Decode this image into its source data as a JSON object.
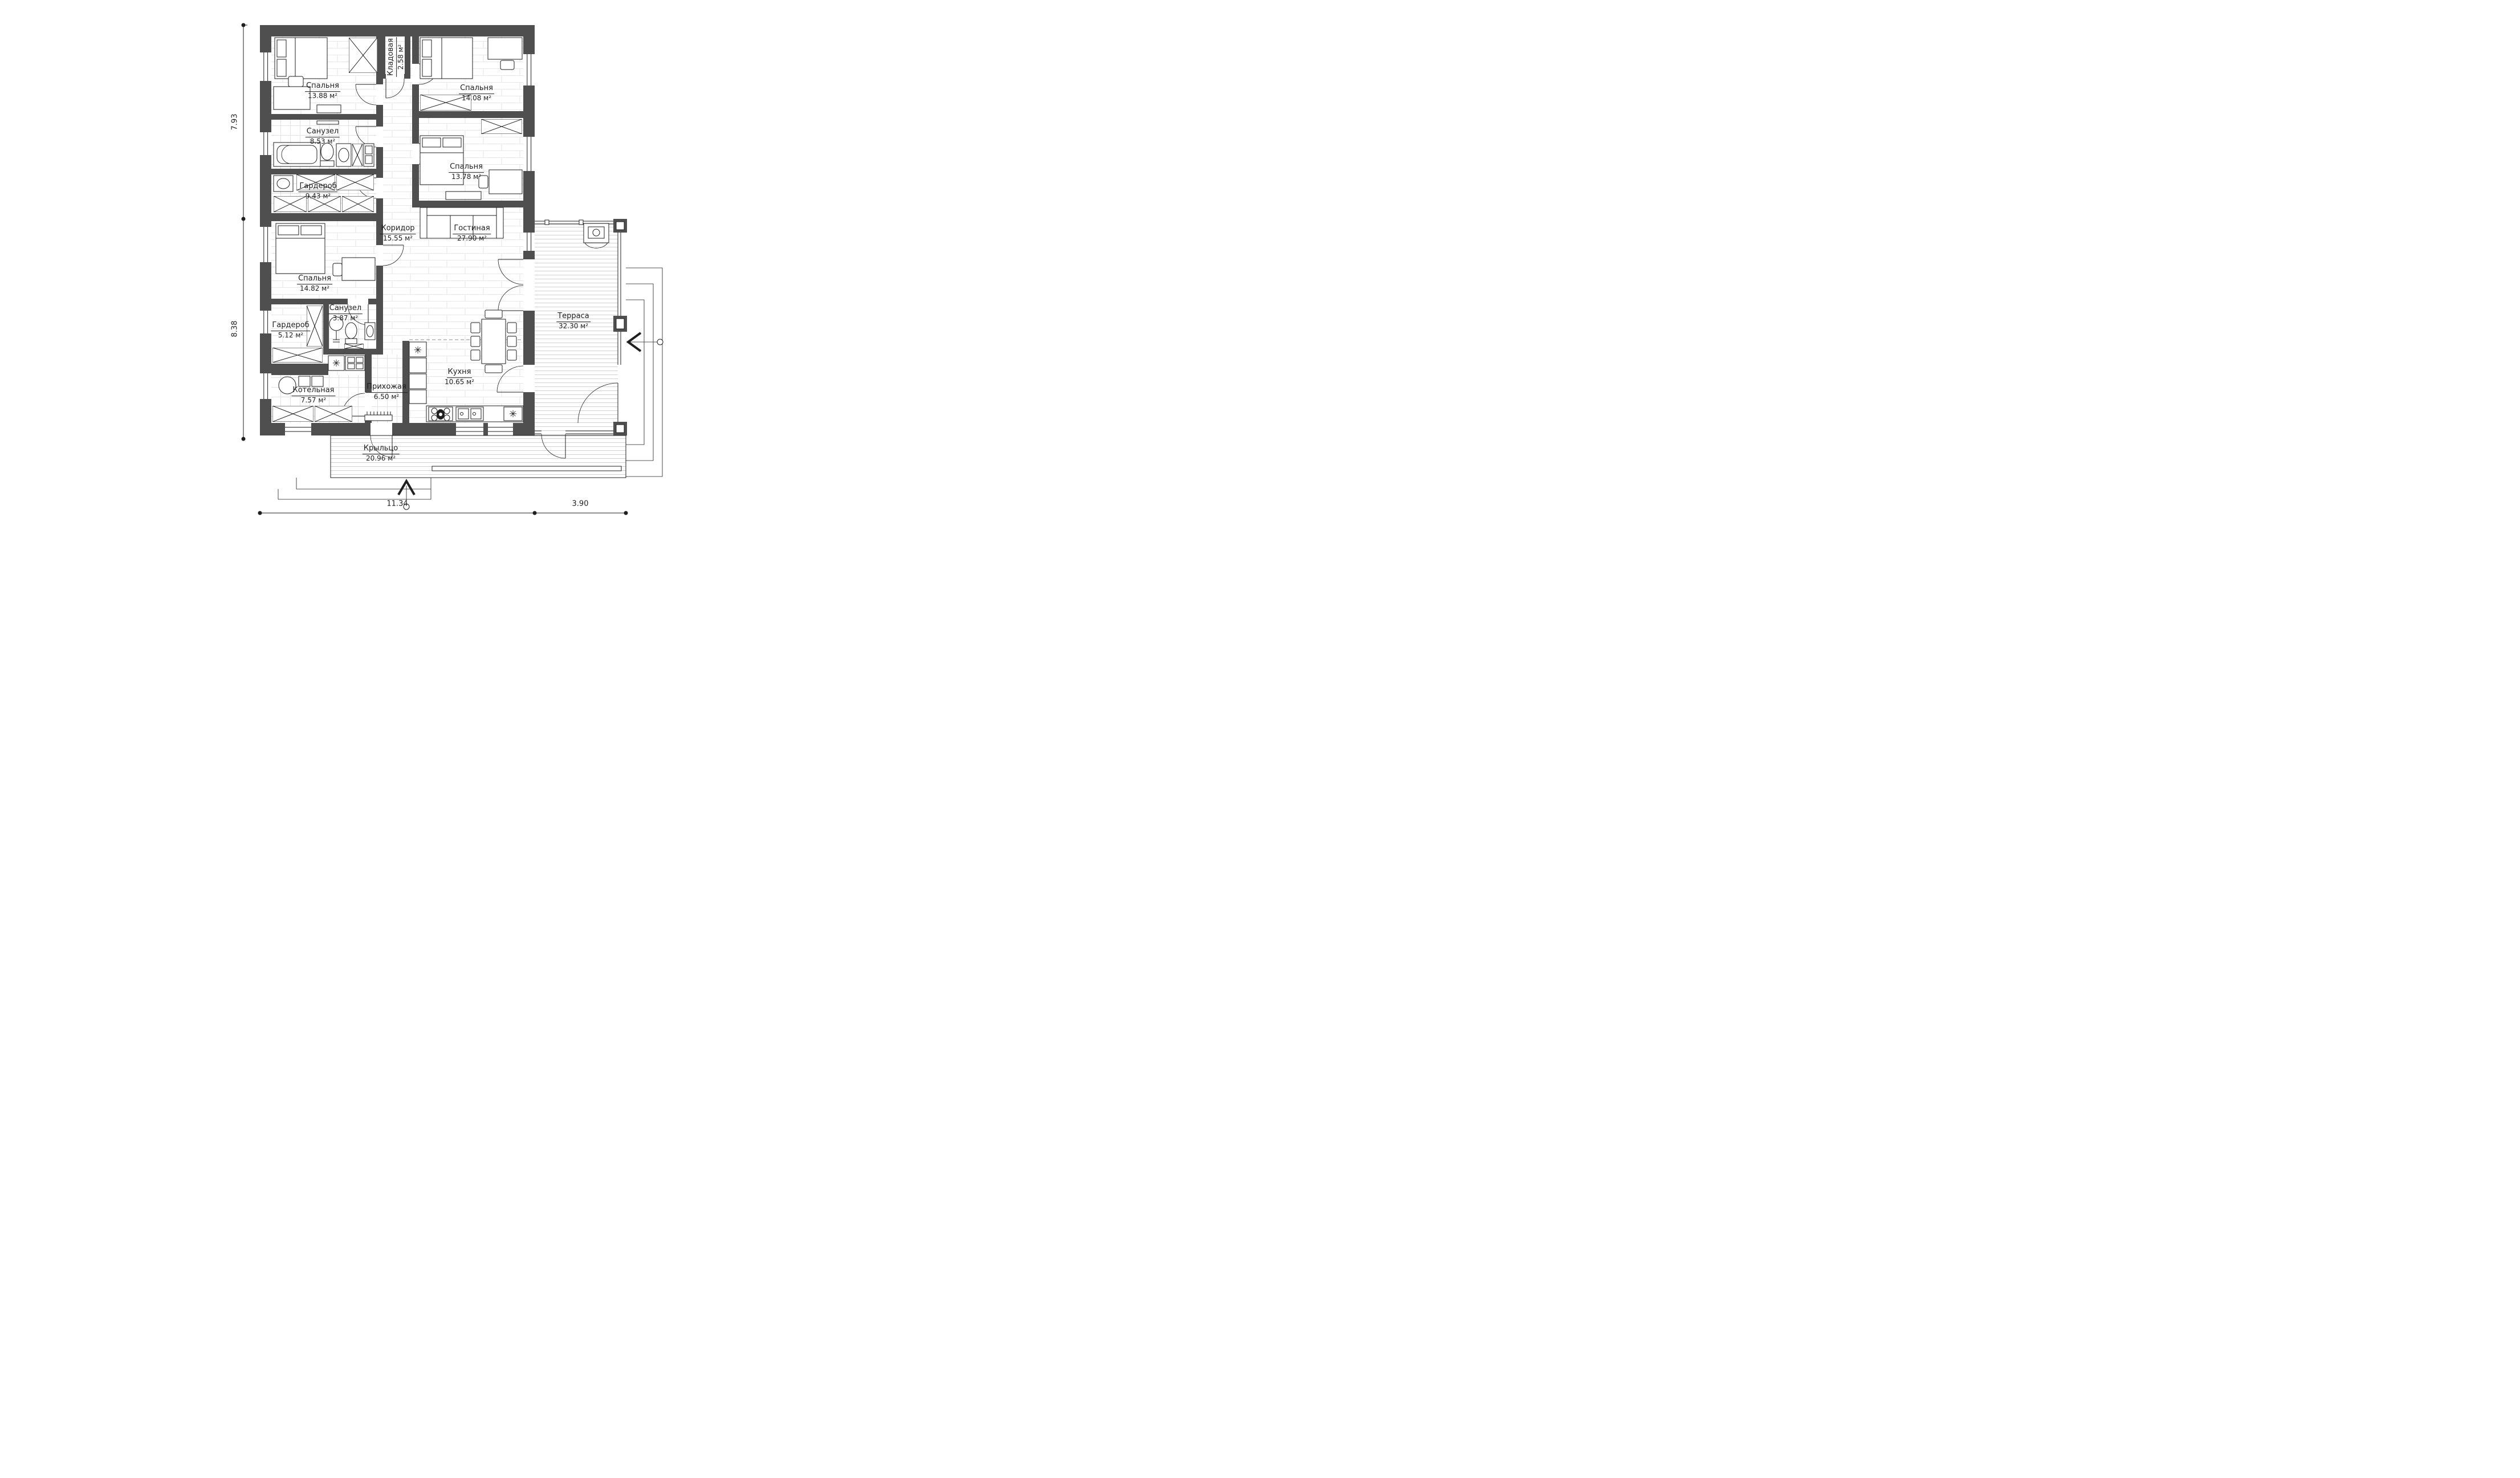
{
  "rooms": [
    {
      "id": "bedroom-1",
      "name": "Спальня",
      "area": "13.88 м²"
    },
    {
      "id": "storage",
      "name": "Кладовая",
      "area": "2.58 м²"
    },
    {
      "id": "bedroom-2",
      "name": "Спальня",
      "area": "14.08 м²"
    },
    {
      "id": "bathroom-1",
      "name": "Санузел",
      "area": "8.53 м²"
    },
    {
      "id": "bedroom-3",
      "name": "Спальня",
      "area": "13.78 м²"
    },
    {
      "id": "wardrobe-1",
      "name": "Гардероб",
      "area": "9.43 м²"
    },
    {
      "id": "corridor",
      "name": "Коридор",
      "area": "15.55 м²"
    },
    {
      "id": "living-room",
      "name": "Гостиная",
      "area": "27.90 м²"
    },
    {
      "id": "bedroom-4",
      "name": "Спальня",
      "area": "14.82 м²"
    },
    {
      "id": "bathroom-2",
      "name": "Санузел",
      "area": "3.87 м²"
    },
    {
      "id": "wardrobe-2",
      "name": "Гардероб",
      "area": "5.12 м²"
    },
    {
      "id": "boiler-room",
      "name": "Котельная",
      "area": "7.57 м²"
    },
    {
      "id": "hallway",
      "name": "Прихожая",
      "area": "6.50 м²"
    },
    {
      "id": "kitchen",
      "name": "Кухня",
      "area": "10.65 м²"
    },
    {
      "id": "terrace",
      "name": "Терраса",
      "area": "32.30 м²"
    },
    {
      "id": "porch",
      "name": "Крыльцо",
      "area": "20.96 м²"
    }
  ],
  "dimensions": {
    "left_top": "7.93",
    "left_bottom": "8.38",
    "bottom_left": "11.34",
    "bottom_right": "3.90"
  },
  "icons": {
    "snowflake": "✳"
  },
  "colors": {
    "wall": "#4f4f4f",
    "line": "#1f1f1f",
    "floor_joint": "#e6e6e6",
    "deck_line": "#d2d2d2",
    "background": "#ffffff"
  }
}
